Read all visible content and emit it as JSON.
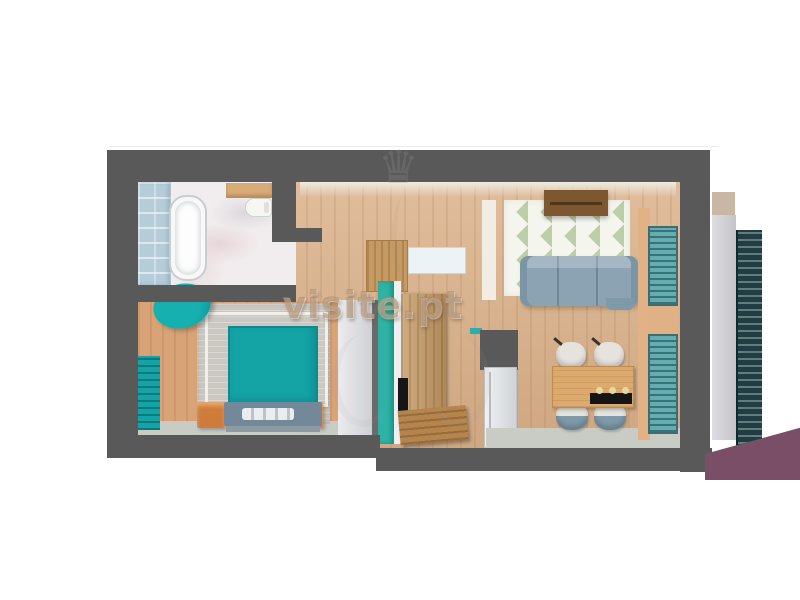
{
  "watermark": {
    "text": "visite.pt",
    "crown_icon": "♛"
  },
  "palette": {
    "wall": "#595959",
    "wood_floor": "#dab088",
    "bedroom_wood": "#d8a377",
    "marble": "#f1edee",
    "tile_blue": "#b5cdd9",
    "teal": "#14a4a6",
    "cabinet_teal": "#2eb3a6",
    "blind_teal": "#64adb0",
    "orange": "#cf7b3a",
    "footboard": "#73899a",
    "sofa": "#8ba3b2",
    "seat_blue": "#7e99a9",
    "rug_green": "#bccfa8",
    "sideboard": "#7d5730",
    "table_wood": "#ddaa6e",
    "wardrobe_wood": "#c59a63",
    "bench_wood": "#b5854d",
    "floor_gray": "#c9cbc5",
    "awning": "#0a3b4a",
    "railing": "#223c44",
    "purple": "#7b4e68"
  }
}
